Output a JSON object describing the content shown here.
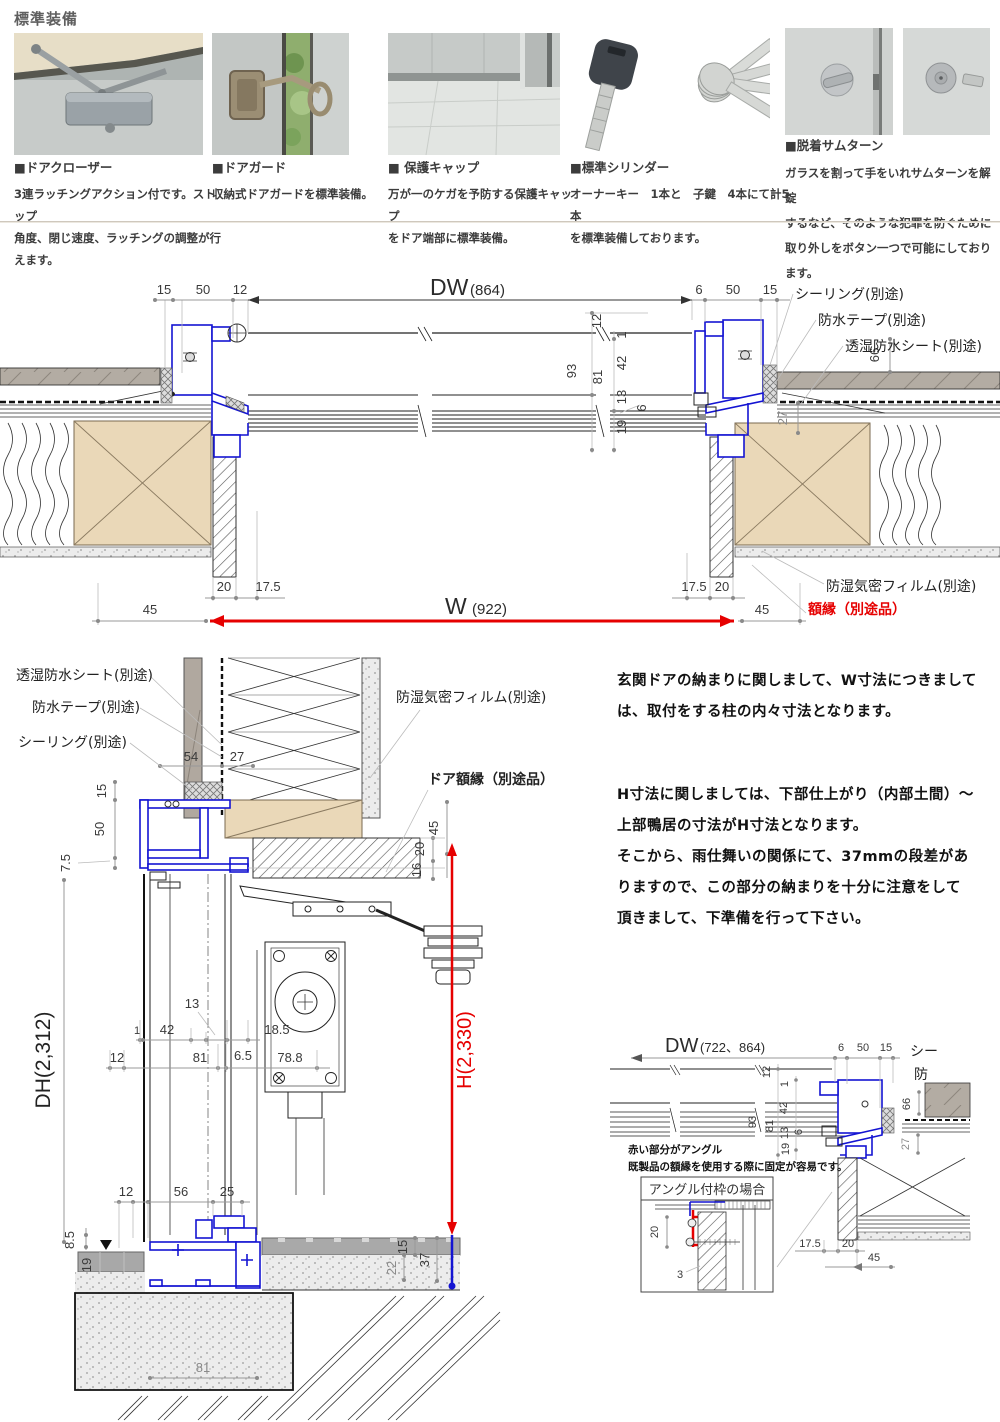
{
  "colors": {
    "accent_blue": "#1414d2",
    "accent_red": "#e60000",
    "wood": "#ead8b8",
    "siding": "#b3aca3"
  },
  "header": {
    "title": "標準装備",
    "items": [
      {
        "name": "■ドアクローザー",
        "desc1": "3連ラッチングアクション付です。ストップ",
        "desc2": "角度、閉じ速度、ラッチングの調整が行えます。",
        "desc3": ""
      },
      {
        "name": "■ドアガード",
        "desc1": "収納式ドアガードを標準装備。",
        "desc2": "",
        "desc3": ""
      },
      {
        "name": "■ 保護キャップ",
        "desc1": "万が一のケガを予防する保護キャップ",
        "desc2": "をドア端部に標準装備。",
        "desc3": ""
      },
      {
        "name": "■標準シリンダー",
        "desc1": "オーナーキー　1本と　子鍵　4本にて計5本",
        "desc2": "を標準装備しております。",
        "desc3": ""
      },
      {
        "name": "■脱着サムターン",
        "desc1": "ガラスを割って手をいれサ厶ターンを解錠",
        "desc2": "するなど、そのような犯罪を防ぐために",
        "desc3": "取り外しをボタン一つで可能にしております。"
      }
    ]
  },
  "plan": {
    "dw": "DW",
    "dw_paren": "(864)",
    "d15l": "15",
    "d50l": "50",
    "d12l": "12",
    "d6r": "6",
    "d50r": "50",
    "d15r": "15",
    "c12": "12",
    "c1": "1",
    "c42": "42",
    "c13": "13",
    "c6": "6",
    "c19": "19",
    "c93": "93",
    "c81": "81",
    "d66": "66",
    "d27": "27",
    "lead1": "シーリング(別途)",
    "lead2": "防水テープ(別途)",
    "lead3": "透湿防水シート(別途)",
    "b20l": "20",
    "b175l": "17.5",
    "b45l": "45",
    "b175r": "17.5",
    "b20r": "20",
    "b45r": "45",
    "w": "W",
    "w_paren": "(922)",
    "film": "防湿気密フィルム(別途)",
    "gakubuchi": "額縁（別途品）"
  },
  "vsec": {
    "lead1": "透湿防水シート(別途)",
    "lead2": "防水テープ(別途)",
    "lead3": "シーリング(別途)",
    "lead4": "防湿気密フィルム(別途)",
    "lead5": "ドア額縁（別途品）",
    "d54": "54",
    "d27": "27",
    "d15": "15",
    "d50": "50",
    "d75": "7.5",
    "d45": "45",
    "d20": "20",
    "d16": "16",
    "dh": "DH(2,312)",
    "h": "H(2,330)",
    "m13": "13",
    "m1": "1",
    "m42": "42",
    "m185": "18.5",
    "m12": "12",
    "m81": "81",
    "m65": "6.5",
    "m788": "78.8",
    "b12": "12",
    "b56": "56",
    "b25": "25",
    "b85": "8.5",
    "b19": "19",
    "b81": "81",
    "b22": "22",
    "b15": "15",
    "b37": "37"
  },
  "notes": {
    "p1l1": "玄関ドアの納まりに関しまして、W寸法につきまして",
    "p1l2": "は、取付をする柱の内々寸法となります。",
    "p2l1": "H寸法に関しましては、下部仕上がり（内部土間）～",
    "p2l2": "上部鴨居の寸法がH寸法となります。",
    "p2l3": "そこから、雨仕舞いの関係にて、37mmの段差があ",
    "p2l4": "りますので、この部分の納まりを十分に注意をして",
    "p2l5": "頂きまして、下準備を行って下さい。"
  },
  "detail": {
    "dw": "DW",
    "dw_paren": "(722、864)",
    "d6": "6",
    "d50": "50",
    "d15": "15",
    "c12": "12",
    "c1": "1",
    "c42": "42",
    "c13": "13",
    "c6": "6",
    "c19": "19",
    "c93": "93",
    "c81": "81",
    "d66": "66",
    "d27": "27",
    "trunc1": "シー",
    "trunc2": "防",
    "note1": "赤い部分がアングル",
    "note2": "既製品の額縁を使用する際に固定が容易です。",
    "box_title": "アングル付枠の場合",
    "bd20": "20",
    "bd3": "3",
    "d175": "17.5",
    "d20": "20",
    "d45": "45"
  }
}
